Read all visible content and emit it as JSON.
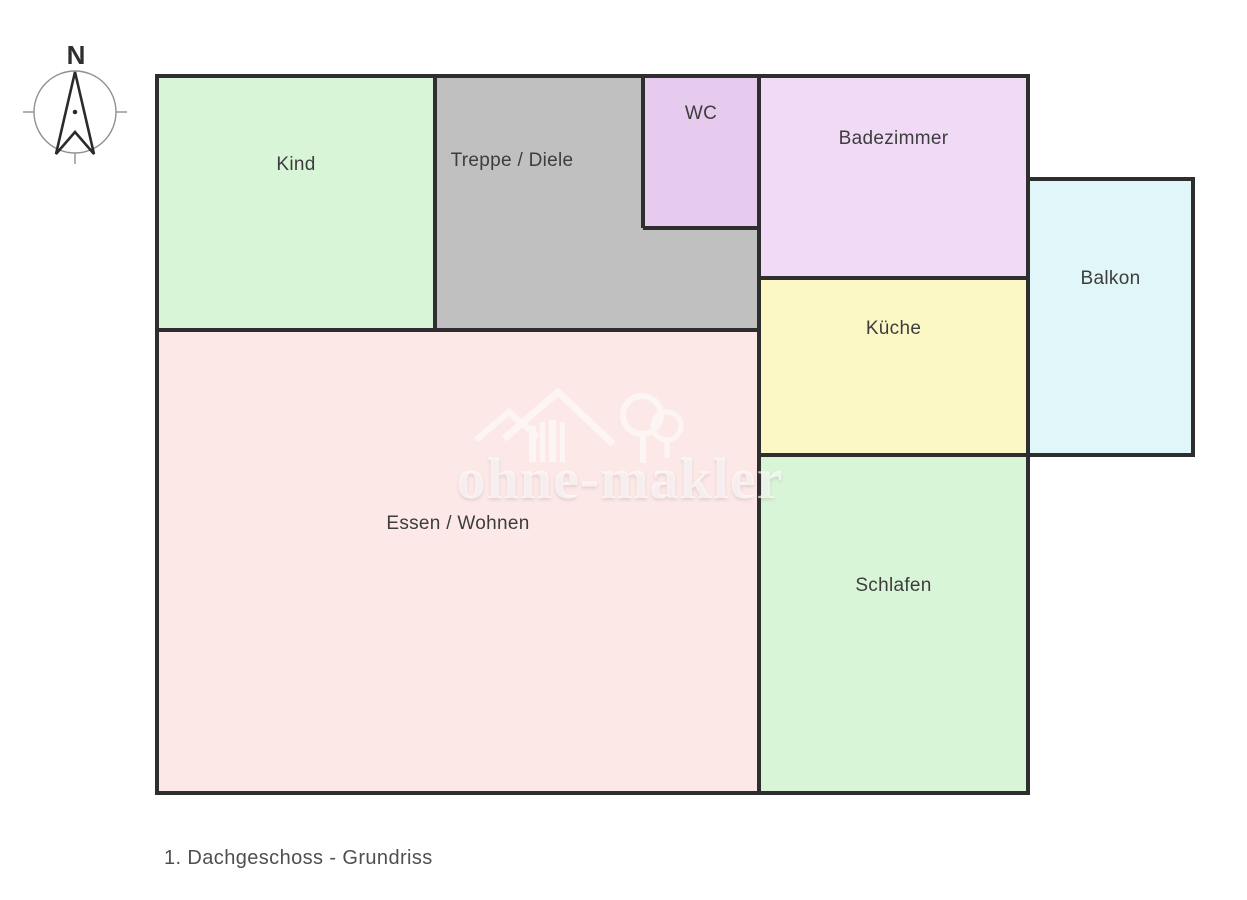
{
  "compass": {
    "north_label": "N"
  },
  "floor_plan": {
    "wall_color": "#2e2e2e",
    "label_color": "#3d3d3d",
    "rooms": [
      {
        "name": "Kind",
        "color": "#d9f5d8"
      },
      {
        "name": "Treppe / Diele",
        "color": "#c0c0c0"
      },
      {
        "name": "WC",
        "color": "#e7cbef"
      },
      {
        "name": "Badezimmer",
        "color": "#f1daf6"
      },
      {
        "name": "Balkon",
        "color": "#e0f6f8"
      },
      {
        "name": "Küche",
        "color": "#fcf8c5"
      },
      {
        "name": "Essen / Wohnen",
        "color": "#fce9e7"
      },
      {
        "name": "Schlafen",
        "color": "#d9f5d8"
      }
    ]
  },
  "watermark": {
    "text": "ohne-makler"
  },
  "caption": "1. Dachgeschoss - Grundriss"
}
